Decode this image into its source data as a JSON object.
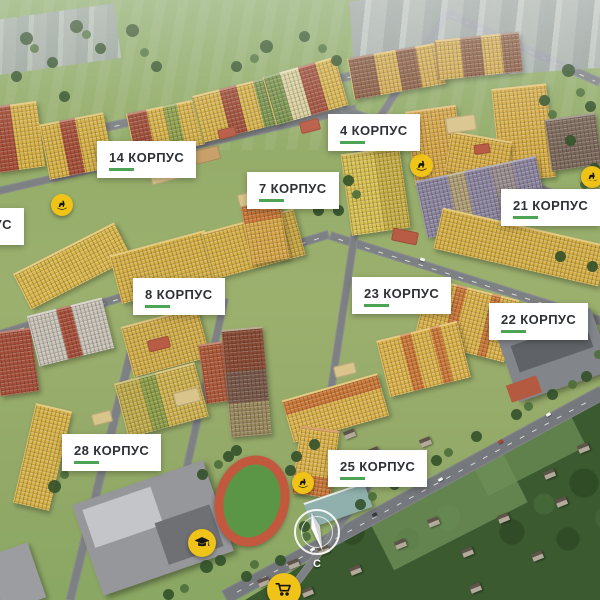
{
  "map_labels": [
    {
      "id": "korpus-unknown",
      "text": "КОРПУС"
    },
    {
      "id": "korpus-14",
      "text": "14 КОРПУС"
    },
    {
      "id": "korpus-4",
      "text": "4 КОРПУС"
    },
    {
      "id": "korpus-7",
      "text": "7 КОРПУС"
    },
    {
      "id": "korpus-21",
      "text": "21 КОРПУС"
    },
    {
      "id": "korpus-8",
      "text": "8 КОРПУС"
    },
    {
      "id": "korpus-23",
      "text": "23 КОРПУС"
    },
    {
      "id": "korpus-22",
      "text": "22 КОРПУС"
    },
    {
      "id": "korpus-28",
      "text": "28 КОРПУС"
    },
    {
      "id": "korpus-25",
      "text": "25 КОРПУС"
    }
  ],
  "amenity_markers": [
    {
      "type": "playground",
      "icon": "rocking-horse-icon"
    },
    {
      "type": "playground",
      "icon": "rocking-horse-icon"
    },
    {
      "type": "playground",
      "icon": "rocking-horse-icon"
    },
    {
      "type": "playground",
      "icon": "rocking-horse-icon"
    },
    {
      "type": "school",
      "icon": "graduation-cap-icon"
    },
    {
      "type": "store",
      "icon": "shopping-cart-icon"
    }
  ],
  "compass": {
    "north_label": "С"
  },
  "colors": {
    "marker_yellow": "#F0C319",
    "underline_green": "#4DA455",
    "label_text": "#2E3136",
    "label_background": "#FFFFFF"
  }
}
